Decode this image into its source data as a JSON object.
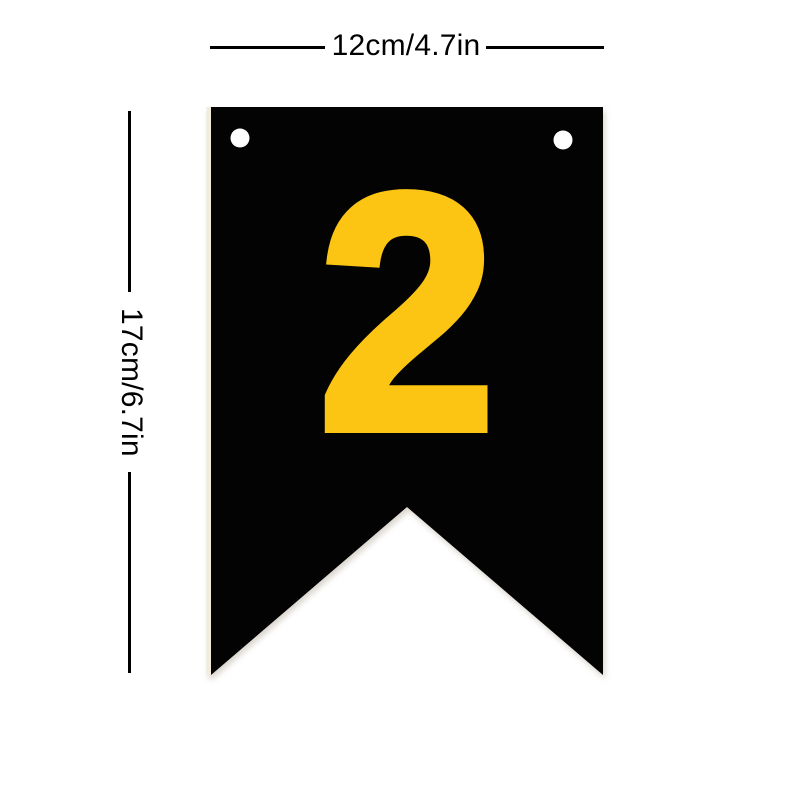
{
  "page": {
    "background_color": "#ffffff"
  },
  "product_image": {
    "banner": {
      "number": "2",
      "number_color": "#FDC513",
      "color": "#030303",
      "edge_strip_color": "#f2ecdd",
      "hole_color": "#ffffff"
    },
    "dimensions": {
      "width_label": "12cm/4.7in",
      "height_label": "17cm/6.7in",
      "line_color": "#000000"
    }
  }
}
